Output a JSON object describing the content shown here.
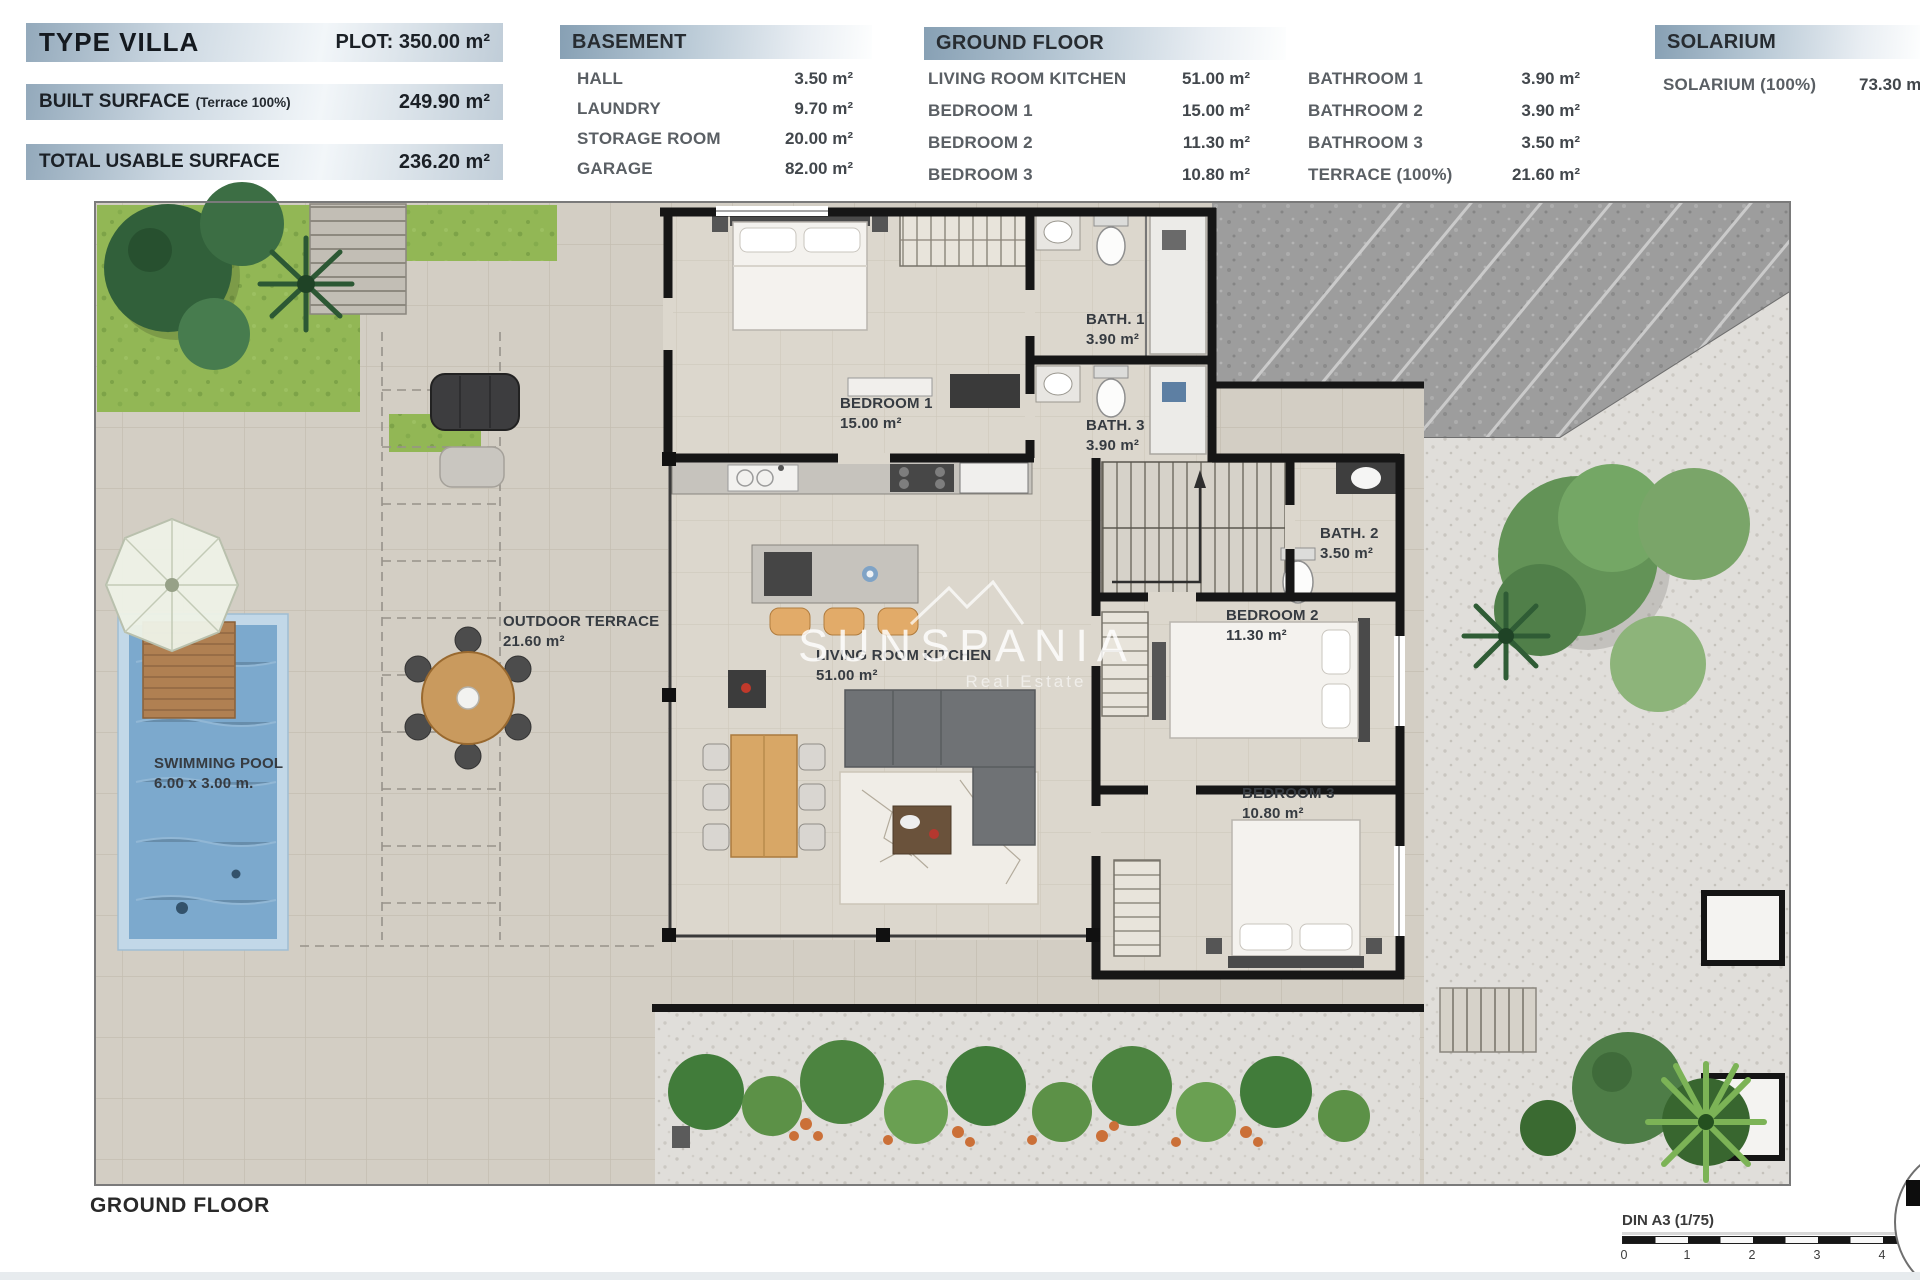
{
  "header": {
    "type_villa": "TYPE VILLA",
    "plot": "PLOT: 350.00 m²",
    "built_surface": "BUILT SURFACE",
    "built_surface_note": "(Terrace 100%)",
    "built_surface_value": "249.90 m²",
    "total_usable": "TOTAL USABLE SURFACE",
    "total_usable_value": "236.20 m²"
  },
  "basement": {
    "title": "BASEMENT",
    "items": [
      {
        "label": "HALL",
        "value": "3.50 m²"
      },
      {
        "label": "LAUNDRY",
        "value": "9.70 m²"
      },
      {
        "label": "STORAGE ROOM",
        "value": "20.00 m²"
      },
      {
        "label": "GARAGE",
        "value": "82.00 m²"
      }
    ]
  },
  "ground_floor": {
    "title": "GROUND FLOOR",
    "items_left": [
      {
        "label": "LIVING ROOM KITCHEN",
        "value": "51.00 m²"
      },
      {
        "label": "BEDROOM 1",
        "value": "15.00 m²"
      },
      {
        "label": "BEDROOM 2",
        "value": "11.30 m²"
      },
      {
        "label": "BEDROOM 3",
        "value": "10.80 m²"
      }
    ],
    "items_right": [
      {
        "label": "BATHROOM 1",
        "value": "3.90 m²"
      },
      {
        "label": "BATHROOM 2",
        "value": "3.90 m²"
      },
      {
        "label": "BATHROOM 3",
        "value": "3.50 m²"
      },
      {
        "label": "TERRACE (100%)",
        "value": "21.60 m²"
      }
    ]
  },
  "solarium": {
    "title": "SOLARIUM",
    "item": {
      "label": "SOLARIUM (100%)",
      "value": "73.30 m²"
    }
  },
  "plan_labels": {
    "bedroom1": {
      "name": "BEDROOM 1",
      "area": "15.00 m²"
    },
    "bath1": {
      "name": "BATH. 1",
      "area": "3.90 m²"
    },
    "bath3": {
      "name": "BATH. 3",
      "area": "3.90 m²"
    },
    "bath2": {
      "name": "BATH. 2",
      "area": "3.50 m²"
    },
    "bedroom2": {
      "name": "BEDROOM 2",
      "area": "11.30 m²"
    },
    "bedroom3": {
      "name": "BEDROOM 3",
      "area": "10.80 m²"
    },
    "living": {
      "name": "LIVING ROOM KITCHEN",
      "area": "51.00 m²"
    },
    "terrace": {
      "name": "OUTDOOR TERRACE",
      "area": "21.60 m²"
    },
    "pool": {
      "name": "SWIMMING POOL",
      "area": "6.00 x 3.00 m."
    }
  },
  "watermark": {
    "name": "SUNSPANIA",
    "subtitle": "Real Estate"
  },
  "footer": {
    "floor": "GROUND FLOOR",
    "scale": "DIN A3 (1/75)",
    "ticks": [
      "0",
      "1",
      "2",
      "3",
      "4"
    ]
  },
  "colors": {
    "header_bar": "#9fb3c3",
    "pool": "#7ca9cd",
    "grass": "#92b755",
    "wall": "#161616",
    "terrace_tile": "#d3cec4"
  }
}
